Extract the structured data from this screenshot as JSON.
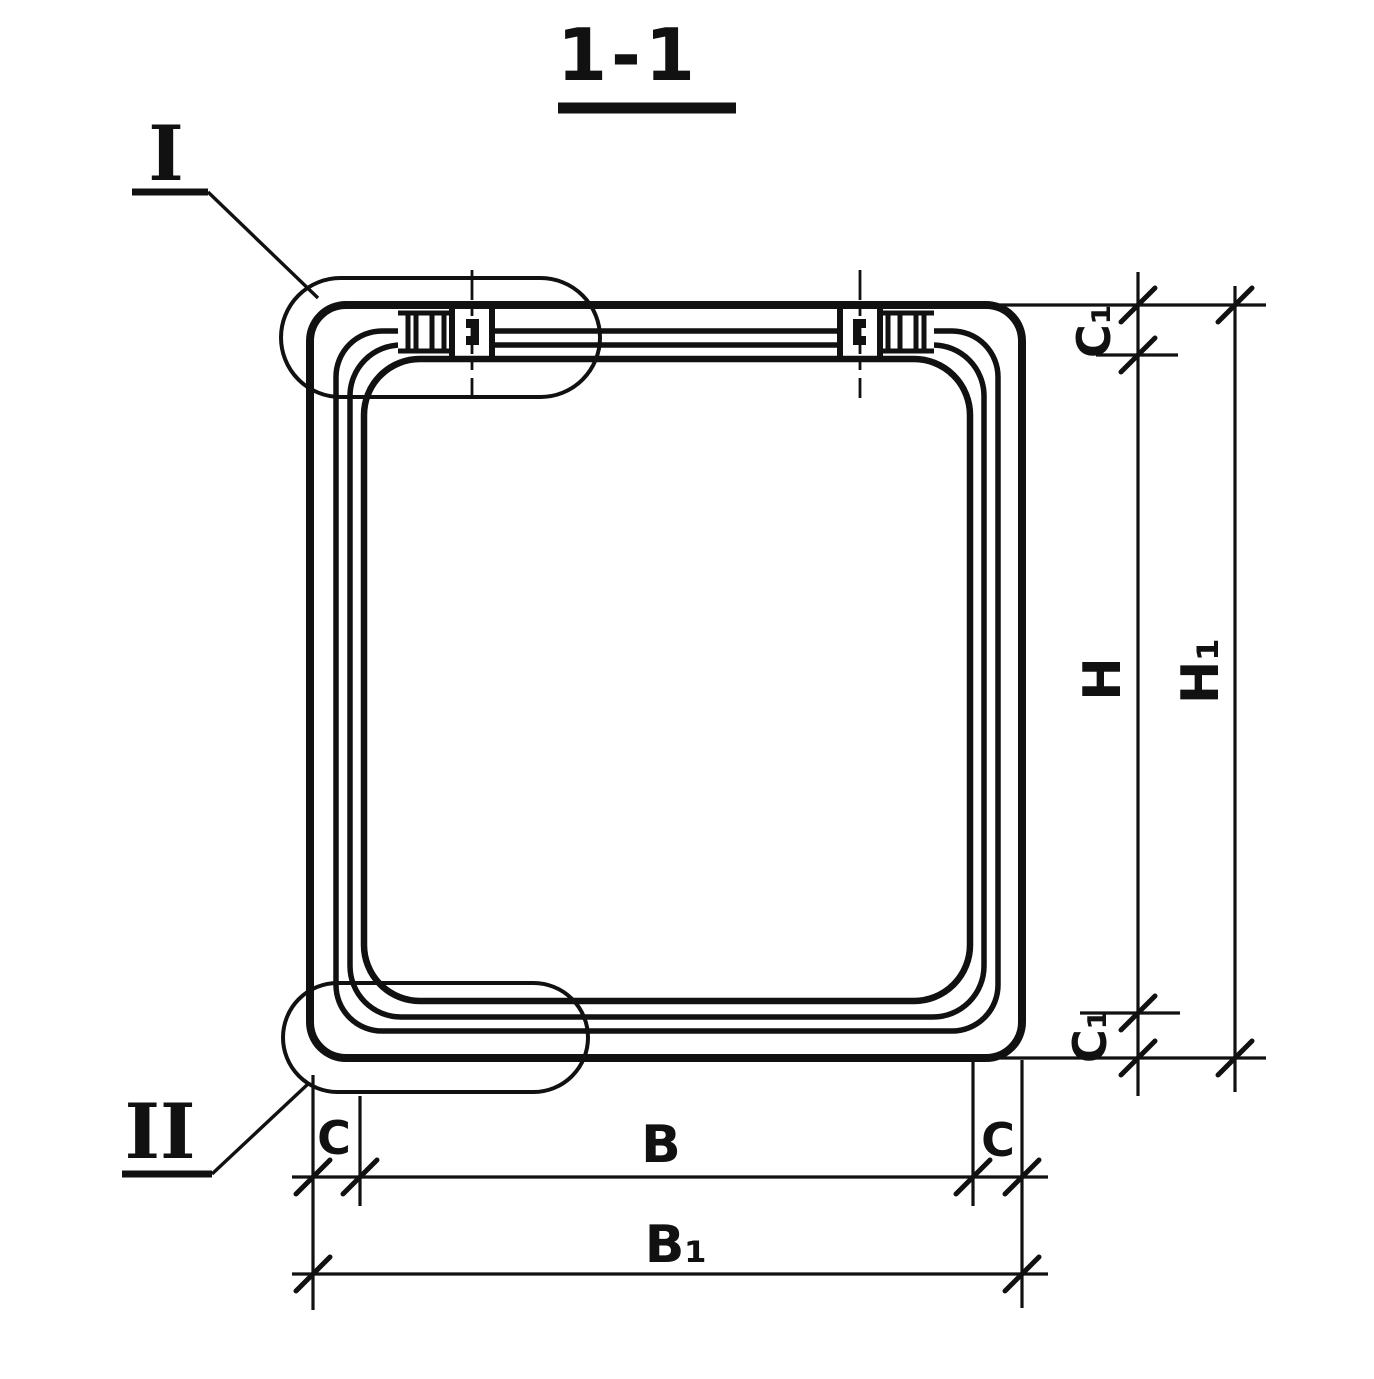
{
  "page": {
    "background": "#ffffff",
    "ink": "#111111"
  },
  "title": {
    "text": "1-1"
  },
  "details": {
    "top_left": {
      "label": "I"
    },
    "bottom_left": {
      "label": "II"
    }
  },
  "dimensions": {
    "c1_top": "C₁",
    "h": "H",
    "h1": "H₁",
    "c1_bottom": "C₁",
    "c_left": "C",
    "b": "B",
    "c_right": "C",
    "b1": "B₁"
  }
}
